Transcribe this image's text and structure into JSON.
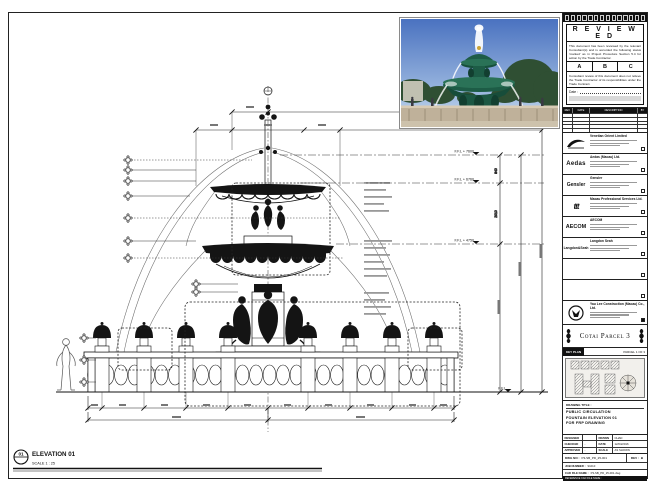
{
  "stamp": {
    "title": "R E V I E W E D",
    "para1": "This document has been reviewed by the relevant Consultant(s) and is accorded the following status 'marked' as in Project Procedure Section 5.4 for action by the Trade Contractor.",
    "cols": [
      "A",
      "B",
      "C"
    ],
    "para2": "Consultant review of this document does not relieve the Trade Contractor of its responsibilities under the Trade Contract.",
    "date_label": "Date :"
  },
  "rev_table": {
    "headers": [
      "REV.",
      "DATE",
      "DESCRIPTION",
      "BY"
    ]
  },
  "consultants": [
    {
      "name": "Venetian Orient Limited",
      "logo": "venetian-swoosh"
    },
    {
      "name": "Aedas (Macau) Ltd.",
      "logo": "Aedas"
    },
    {
      "name": "Gensler",
      "logo": "Gensler"
    },
    {
      "name": "Macau Professional Services Ltd.",
      "logo": "ttt"
    },
    {
      "name": "AECOM",
      "logo": "AECOM"
    },
    {
      "name": "Langdon Seah",
      "logo": "Langdon&Seah"
    }
  ],
  "contractor": {
    "name": "Yau Lee Construction (Macau) Co., Ltd."
  },
  "project": {
    "title": "Cotai Parcel 3"
  },
  "key_plan": {
    "label": "KEY PLAN",
    "right_label": "PARCEL 1 OF 3"
  },
  "drawing_title": {
    "label": "DRAWING TITLE :",
    "line1": "PUBLIC CIRCULATION",
    "line2": "FOUNTAIN ELEVATION 01",
    "line3": "FOR FRP DRAWING"
  },
  "info": {
    "designed_label": "DESIGNED",
    "designed": "",
    "drawn_label": "DRAWN",
    "drawn": "CHAD",
    "checked_label": "CHECKED",
    "checked": "-",
    "date_label": "DATE",
    "date": "12/04/2016",
    "approved_label": "APPROVED",
    "approved": "-",
    "scale_label": "SCALE",
    "scale": "AS SHOWN"
  },
  "dwg": {
    "no_label": "DWG NO :",
    "no": "P3-SB_PD_25-001",
    "rev_label": "REV :",
    "rev": "B",
    "job_label": "JOB NUMBER :",
    "job": "91010",
    "cad_label": "CAD FILE NAME :",
    "cad": "P3-SB_PD_25-001.dwg",
    "ref_label": "REFERENCE CAD FILE NAME :"
  },
  "elevation_callout": {
    "number": "01",
    "title": "ELEVATION 01",
    "scale": "SCALE  1 : 25"
  },
  "levels": [
    {
      "label": "F.F.L + 7600"
    },
    {
      "label": "F.F.L + 6760"
    },
    {
      "label": "F.F.L + 4750"
    },
    {
      "label": "F.F.L"
    }
  ],
  "dims": {
    "v1": "840",
    "v2": "2010"
  }
}
